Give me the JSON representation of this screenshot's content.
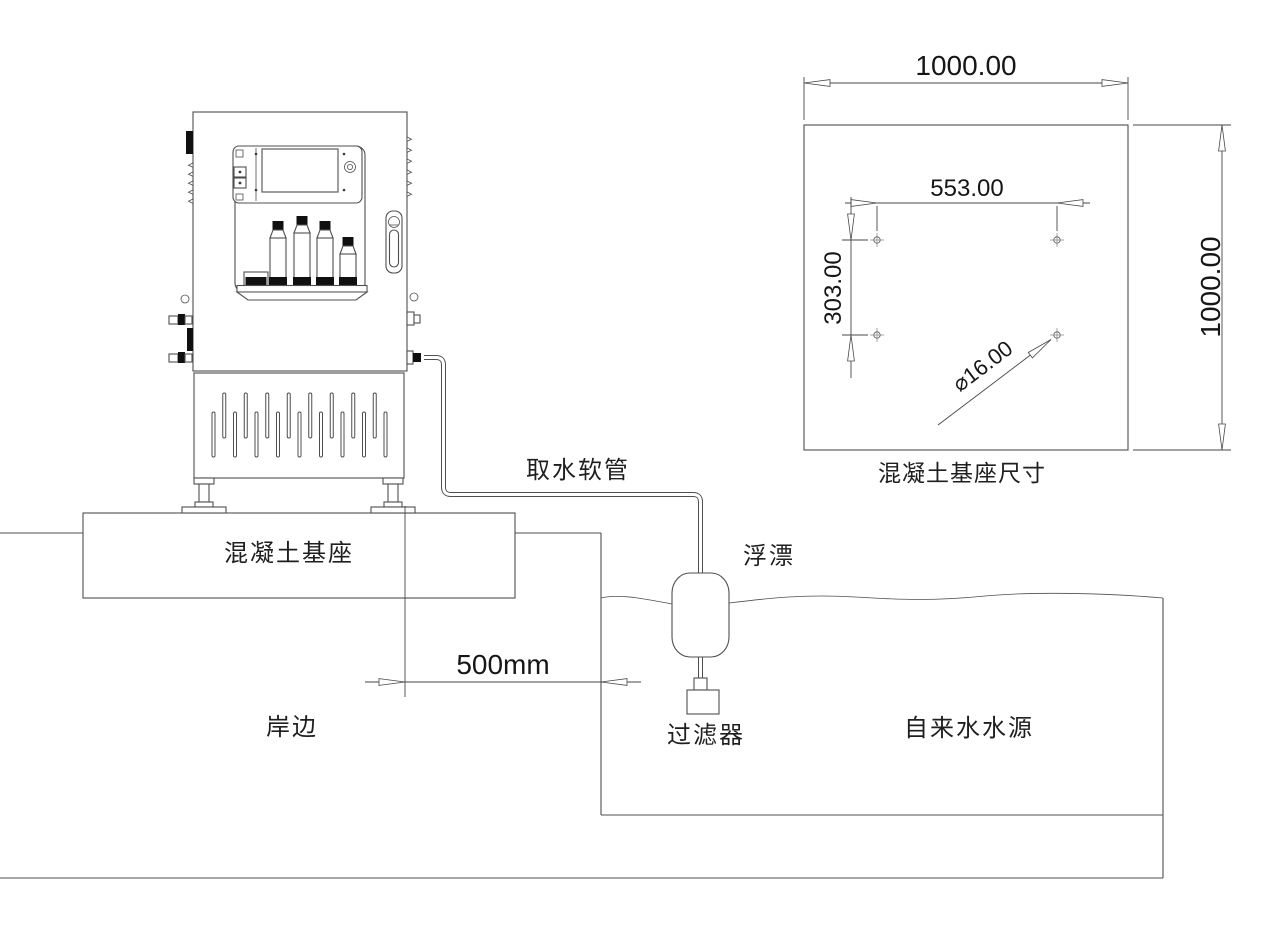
{
  "side_view": {
    "labels": {
      "intake_hose": "取水软管",
      "float_buoy": "浮漂",
      "concrete_base": "混凝土基座",
      "shore": "岸边",
      "filter": "过滤器",
      "water_source": "自来水水源"
    },
    "dimensions": {
      "device_to_shore": "500mm"
    }
  },
  "plan_view": {
    "caption": "混凝土基座尺寸",
    "dimensions": {
      "overall_width": "1000.00",
      "overall_height": "1000.00",
      "hole_pitch_horizontal": "553.00",
      "hole_pitch_vertical": "303.00",
      "hole_diameter": "⌀16.00"
    }
  },
  "colors": {
    "background": "#ffffff",
    "line": "#4f4f4f",
    "dimension_line": "#474747",
    "text": "#1f1f1f",
    "dark_fill": "#101010"
  }
}
